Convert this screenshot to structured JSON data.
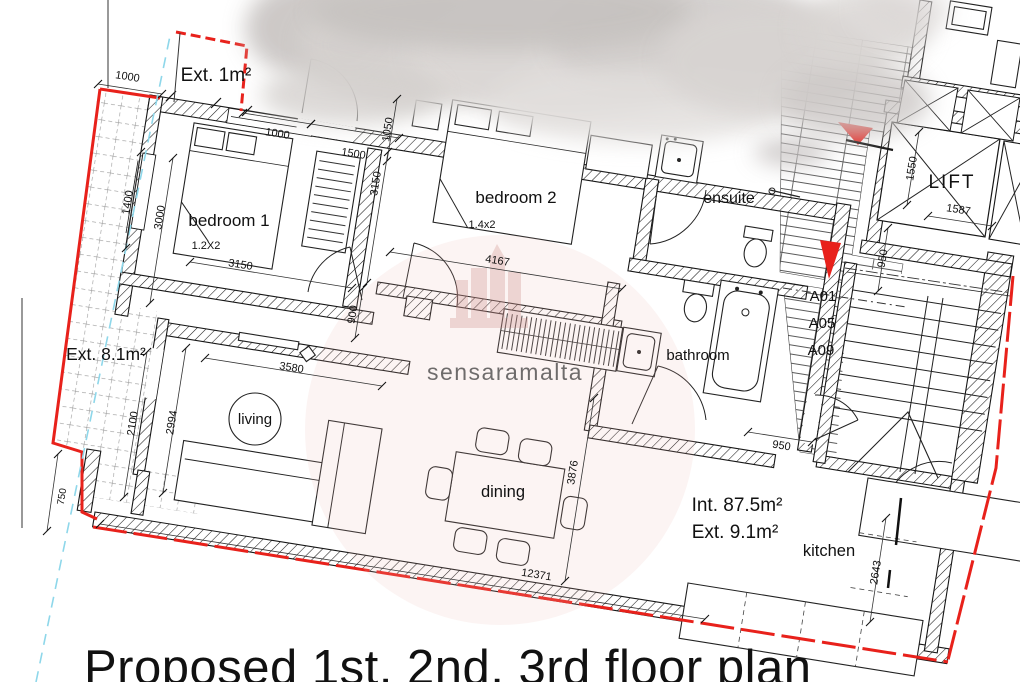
{
  "title": "Proposed 1st, 2nd, 3rd floor plan",
  "watermark": "sensaramalta",
  "rooms": {
    "bedroom1": "bedroom 1",
    "bedroom1_bed": "1.2X2",
    "bedroom2": "bedroom 2",
    "bedroom2_bed": "1.4x2",
    "ensuite": "ensuite",
    "bathroom": "bathroom",
    "living": "living",
    "dining": "dining",
    "kitchen": "kitchen",
    "lift": "LIFT"
  },
  "areas": {
    "balcony": "Ext. 1m²",
    "terrace": "Ext. 8.1m²",
    "internal": "Int. 87.5m²",
    "external": "Ext. 9.1m²"
  },
  "units": [
    "A01",
    "A05",
    "A09"
  ],
  "dims": {
    "d1000a": "1000",
    "d1000b": "1000",
    "d1500": "1500",
    "d1050": "1050",
    "d3150a": "3150",
    "d1400": "1400",
    "d3000": "3000",
    "d3150b": "3150",
    "d4167": "4167",
    "d900": "900",
    "d3580": "3580",
    "d2100": "2100",
    "d2994": "2994",
    "d750": "750",
    "d3876": "3876",
    "d12371": "12371",
    "d950a": "950",
    "d950b": "950",
    "d2643": "2643",
    "d1550": "1550",
    "d1587": "1587"
  },
  "colors": {
    "boundary_red": "#e8211b",
    "guide_cyan": "#8ed7ea",
    "watermark_pink": "#cf9d98",
    "wall_black": "#1b1b1b"
  }
}
